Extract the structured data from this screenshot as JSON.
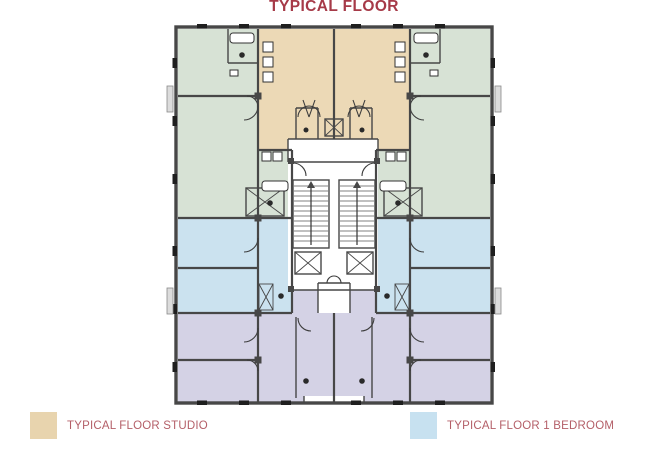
{
  "title": "TYPICAL FLOOR",
  "legend": {
    "items": [
      {
        "label": "TYPICAL FLOOR STUDIO",
        "color": "#e8d4ae"
      },
      {
        "label": "TYPICAL FLOOR 1 BEDROOM",
        "color": "#c7e1f0"
      }
    ]
  },
  "colors": {
    "title_text": "#a63a48",
    "legend_text": "#b45f68",
    "studio": "#ecd9b6",
    "one_bedroom": "#cbe2ef",
    "unit_green": "#d7e2d5",
    "unit_lavender": "#d4d2e5",
    "legend_studio": "#e8d4ae",
    "legend_one_bedroom": "#c7e1f0",
    "wall": "#474747",
    "core_fill": "#ebebeb"
  }
}
